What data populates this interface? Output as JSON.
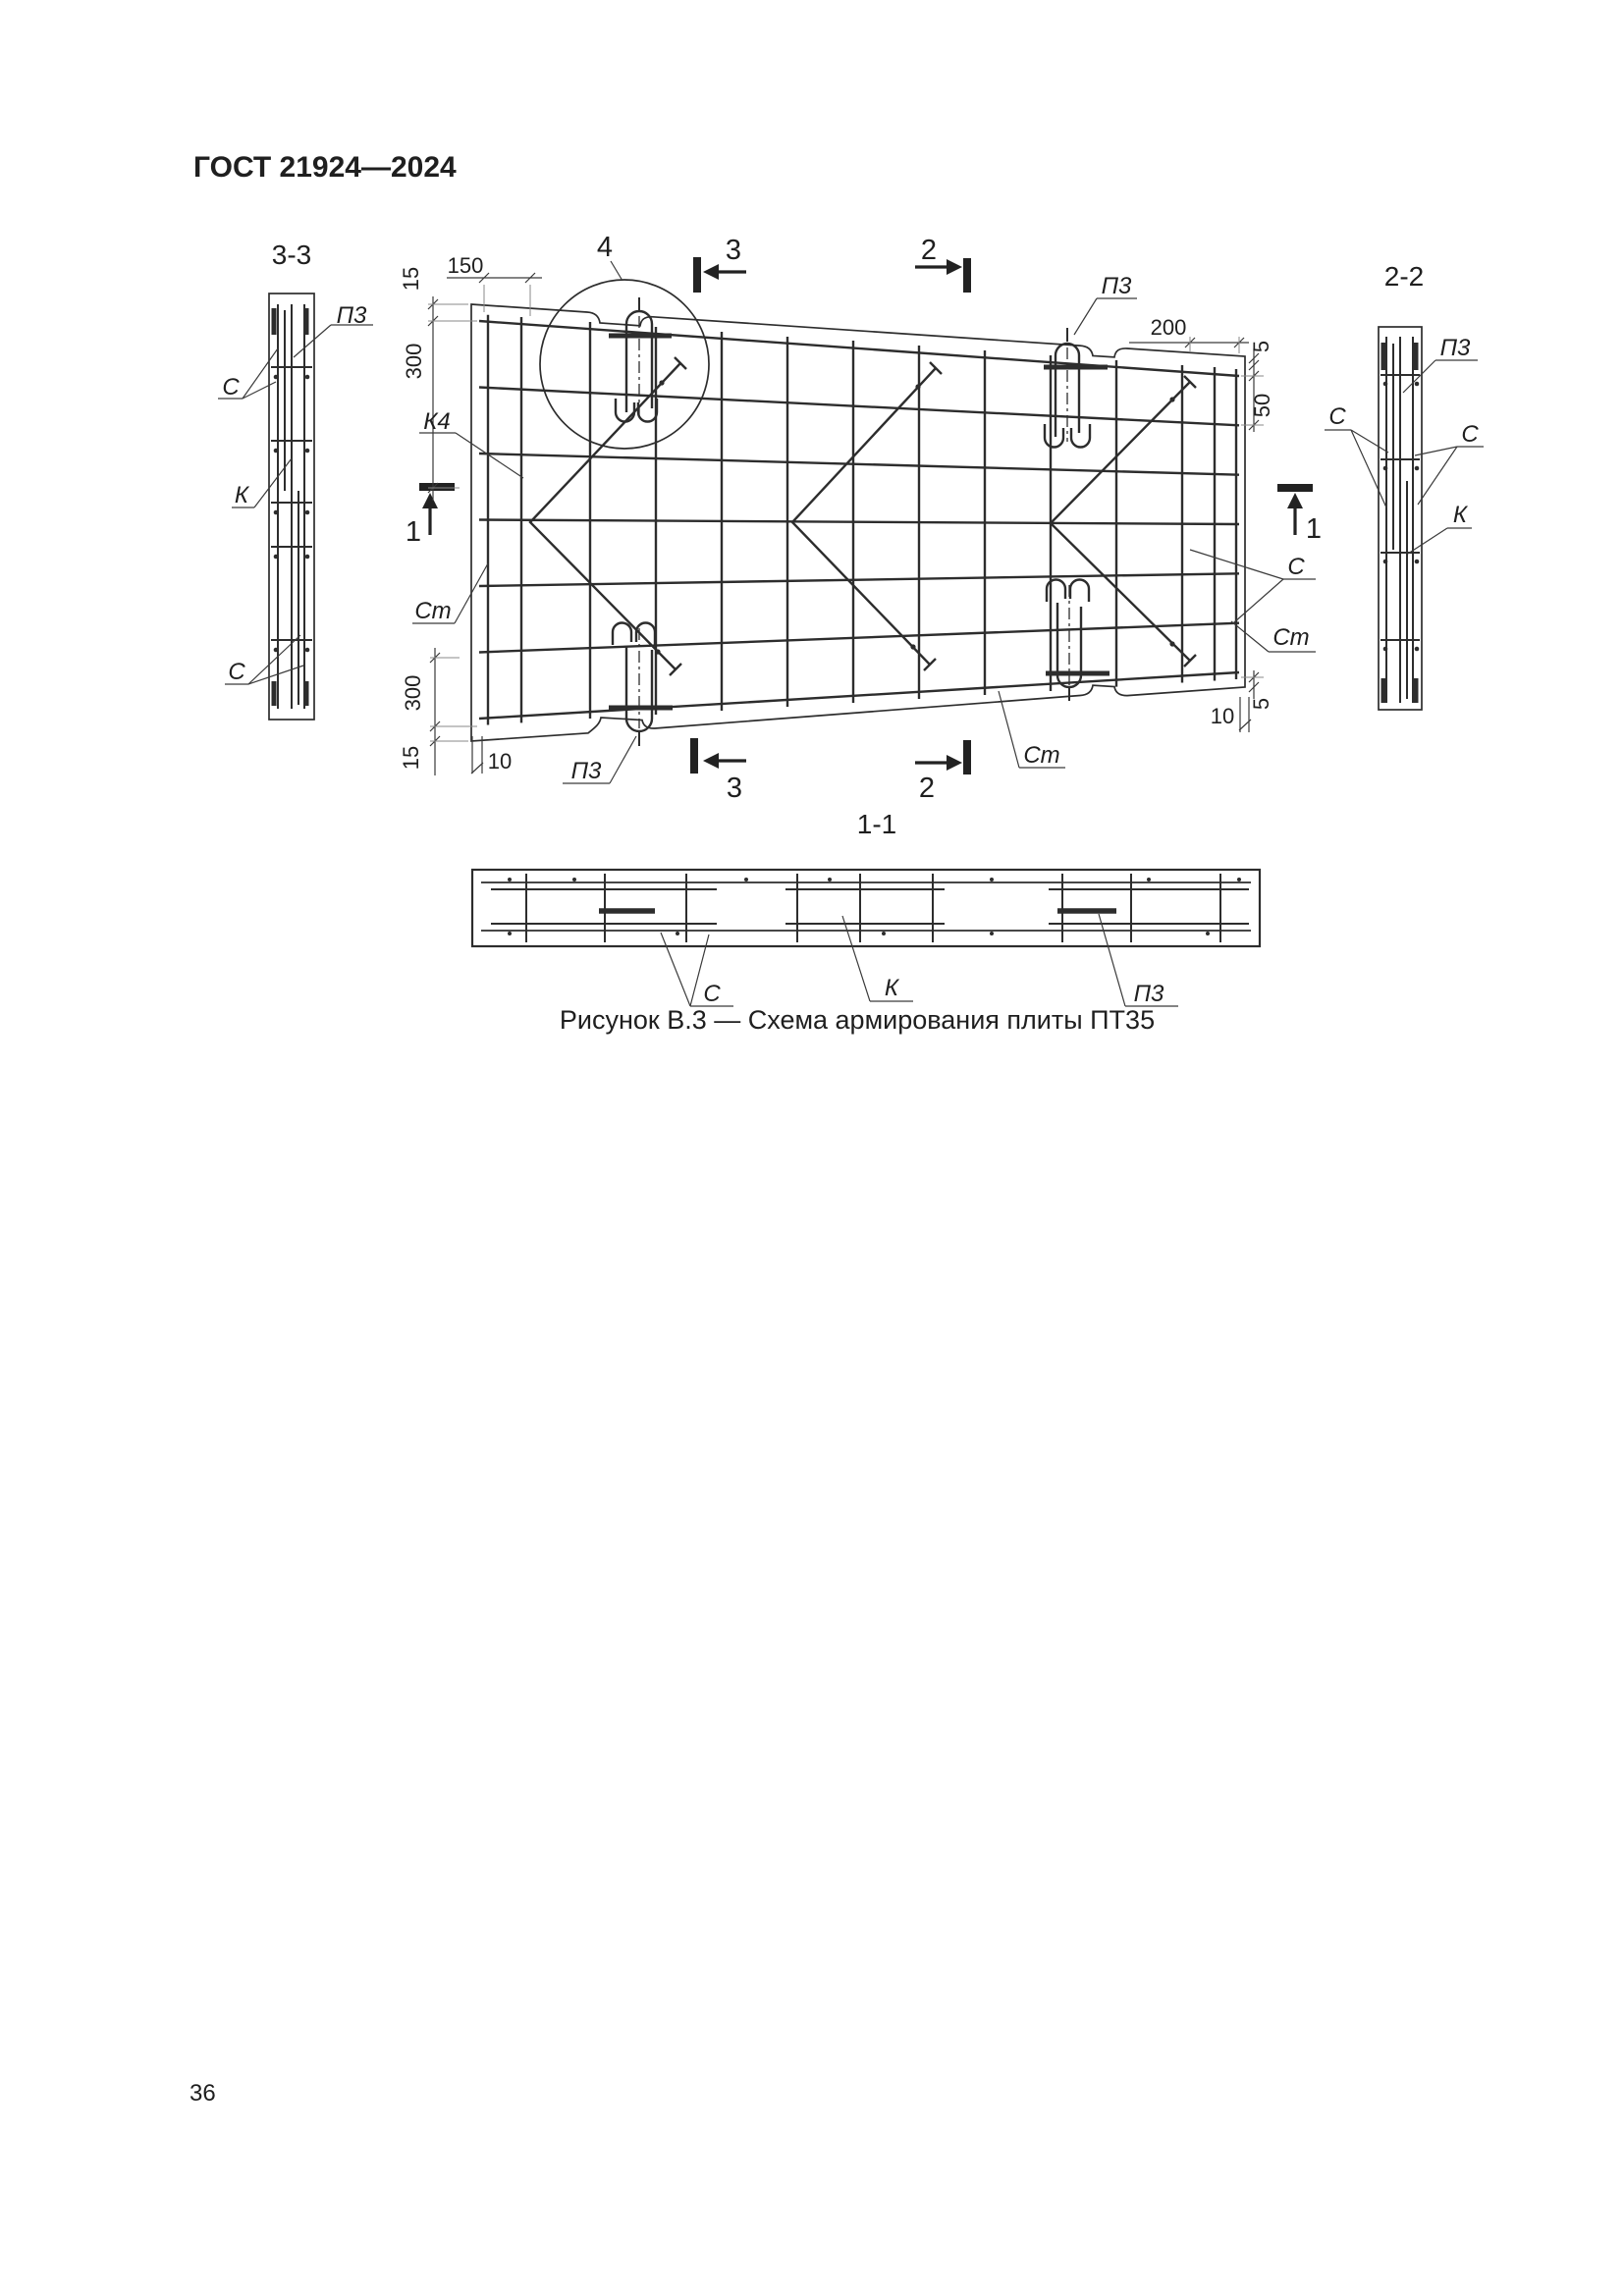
{
  "document": {
    "header": "ГОСТ 21924—2024",
    "page_number": "36",
    "figure_caption": "Рисунок В.3 — Схема армирования плиты ПТ35"
  },
  "section_titles": {
    "s33": "3-3",
    "s22": "2-2",
    "s11": "1-1"
  },
  "section_marks": {
    "m1": "1",
    "m2": "2",
    "m3": "3",
    "detail": "4"
  },
  "rebar_marks": {
    "c": "С",
    "k": "К",
    "k4": "К4",
    "pz": "П3",
    "st": "Ст"
  },
  "dimensions": {
    "d5": "5",
    "d10": "10",
    "d15": "15",
    "d50": "50",
    "d150": "150",
    "d200": "200",
    "d300": "300"
  },
  "colors": {
    "line": "#2d2d2d",
    "text": "#1f1f1f",
    "background": "#ffffff"
  }
}
